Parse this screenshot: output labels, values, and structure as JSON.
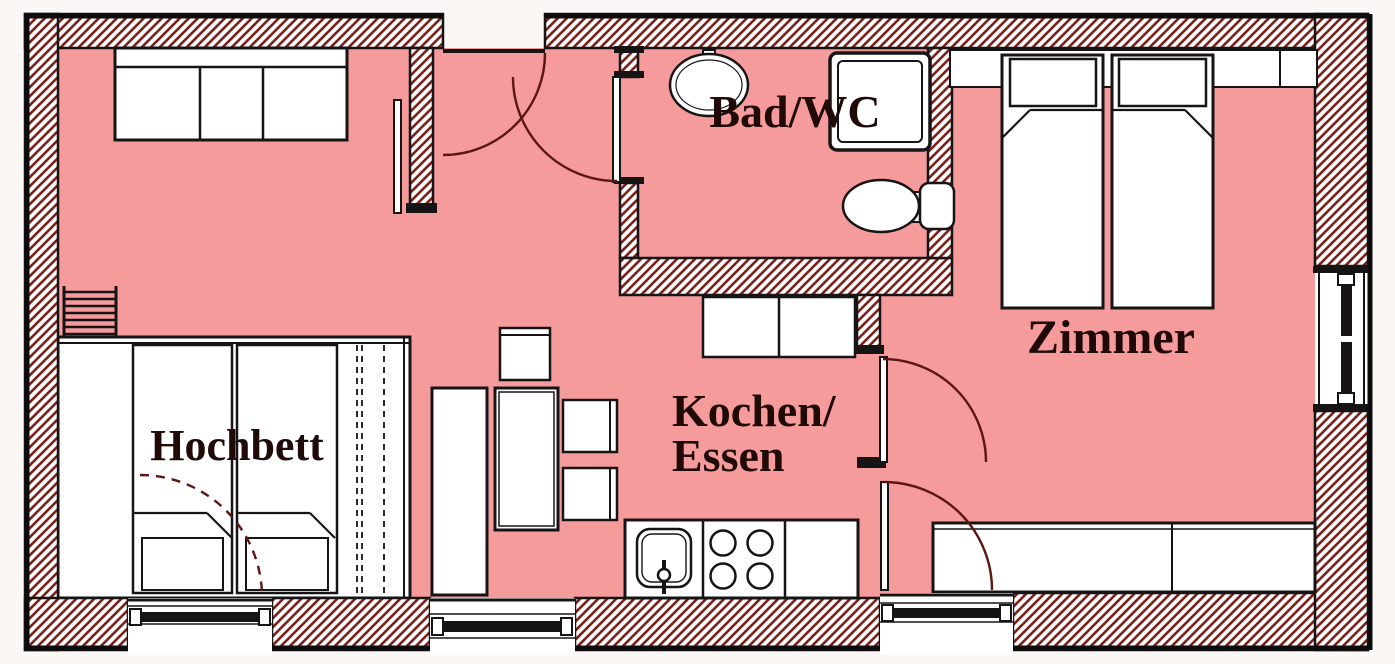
{
  "title": "Apartment floor plan",
  "rooms": [
    {
      "id": "hochbett",
      "label": "Hochbett"
    },
    {
      "id": "kochen_essen",
      "label_line1": "Kochen/",
      "label_line2": "Essen"
    },
    {
      "id": "bad_wc",
      "label": "Bad/WC"
    },
    {
      "id": "zimmer",
      "label": "Zimmer"
    }
  ],
  "colors": {
    "floor": "#f59b9b",
    "hatch_line": "#7a221b",
    "wall_outline": "#161414",
    "label_text": "#200a08",
    "furniture_fill": "#ffffff",
    "door_arc": "#5a1714"
  },
  "fixtures": [
    "sofa",
    "loft-bed-ladder",
    "loft-bed-mattress-left",
    "loft-bed-mattress-right",
    "kitchen-side-counter",
    "dining-table",
    "dining-chair-top",
    "dining-chair-right-1",
    "dining-chair-right-2",
    "kitchen-sink",
    "stove-4-burners",
    "kitchen-cupboard",
    "washbasin",
    "shower",
    "toilet",
    "single-bed-left",
    "single-bed-right",
    "headboard-shelf",
    "sideboard"
  ],
  "windows": [
    "loft-window-bottom",
    "kitchen-window-bottom",
    "zimmer-window-bottom",
    "zimmer-window-right"
  ],
  "doors": [
    "entrance-door",
    "living-room-door",
    "bathroom-door",
    "zimmer-door-upper",
    "zimmer-door-lower",
    "loft-dashed-swing"
  ]
}
